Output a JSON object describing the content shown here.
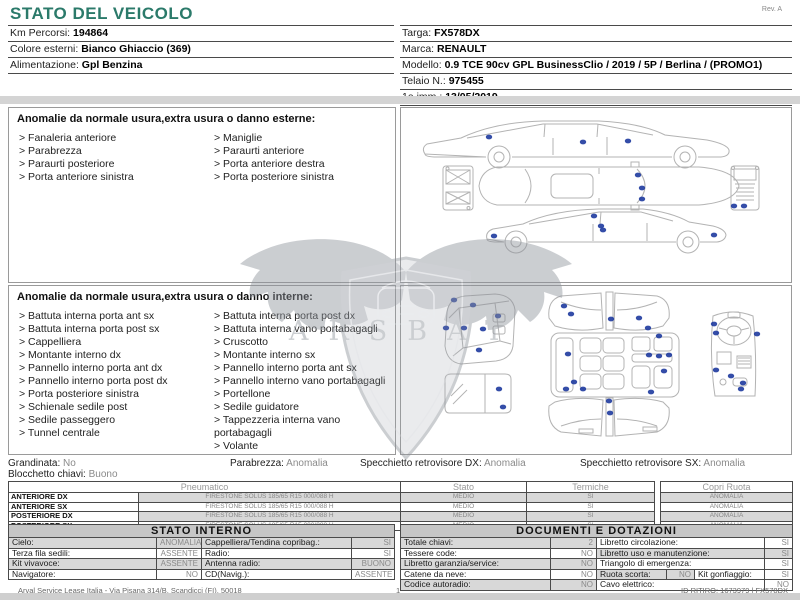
{
  "page": {
    "title": "STATO DEL VEICOLO",
    "revision": "Rev. A",
    "footer": {
      "company": "Arval Service Lease Italia - Via Pisana 314/B, Scandicci (FI), 50018",
      "page_number": "1",
      "ritiro_id": "ID RITIRO: 1673979 | FX578DX"
    }
  },
  "vehicle": {
    "left": [
      {
        "label": "Km Percorsi:",
        "value": "194864"
      },
      {
        "label": "Colore esterni:",
        "value": "Bianco Ghiaccio (369)"
      },
      {
        "label": "Alimentazione:",
        "value": "Gpl Benzina"
      }
    ],
    "right": [
      {
        "label": "Targa:",
        "value": "FX578DX"
      },
      {
        "label": "Marca:",
        "value": "RENAULT"
      },
      {
        "label": "Modello:",
        "value": "0.9 TCE 90cv GPL BusinessClio / 2019 / 5P / Berlina / (PROMO1)"
      },
      {
        "label": "Telaio N.:",
        "value": "975455"
      },
      {
        "label": "1a imm.:",
        "value": "13/05/2019"
      }
    ]
  },
  "external_anomalies": {
    "title": "Anomalie da normale usura,extra usura o danno esterne:",
    "col1": [
      "> Fanaleria anteriore",
      "> Parabrezza",
      "> Paraurti posteriore",
      "> Porta anteriore sinistra"
    ],
    "col2": [
      "> Maniglie",
      "> Paraurti anteriore",
      "> Porta anteriore destra",
      "> Porta posteriore sinistra"
    ]
  },
  "internal_anomalies": {
    "title": "Anomalie da normale usura,extra usura o danno interne:",
    "col1": [
      "> Battuta interna porta ant sx",
      "> Battuta interna porta post sx",
      "> Cappelliera",
      "> Montante interno dx",
      "> Pannello interno porta ant dx",
      "> Pannello interno porta post dx",
      "> Porta posteriore sinistra",
      "> Schienale sedile post",
      "> Sedile passeggero",
      "> Tunnel centrale"
    ],
    "col2": [
      "> Battuta interna porta post dx",
      "> Battuta interna vano portabagagli",
      "> Cruscotto",
      "> Montante interno sx",
      "> Pannello interno porta ant sx",
      "> Pannello interno vano portabagagli",
      "> Portellone",
      "> Sedile guidatore",
      "> Tappezzeria interna vano portabagagli",
      "> Volante"
    ]
  },
  "checks": [
    {
      "label": "Grandinata:",
      "value": "No"
    },
    {
      "label": "Parabrezza:",
      "value": "Anomalia"
    },
    {
      "label": "Specchietto retrovisore DX:",
      "value": "Anomalia"
    },
    {
      "label": "Specchietto retrovisore SX:",
      "value": "Anomalia"
    },
    {
      "label": "Blocchetto chiavi:",
      "value": "Buono"
    }
  ],
  "tyres": {
    "headers": [
      "Pneumatico",
      "Stato",
      "Termiche",
      "Copri Ruota"
    ],
    "rows": [
      {
        "position": "ANTERIORE DX",
        "tyre": "FIRESTONE SOLUS 185/65 R15 000/088 H",
        "stato": "MEDIO",
        "termiche": "SI",
        "copri_ruota": "ANOMALIA"
      },
      {
        "position": "ANTERIORE SX",
        "tyre": "FIRESTONE SOLUS 185/65 R15 000/088 H",
        "stato": "MEDIO",
        "termiche": "SI",
        "copri_ruota": "ANOMALIA"
      },
      {
        "position": "POSTERIORE DX",
        "tyre": "FIRESTONE SOLUS 185/65 R15 000/088 H",
        "stato": "MEDIO",
        "termiche": "SI",
        "copri_ruota": "ANOMALIA"
      },
      {
        "position": "POSTERIORE SX",
        "tyre": "FIRESTONE SOLUS 185/65 R15 000/088 H",
        "stato": "MEDIO",
        "termiche": "SI",
        "copri_ruota": "ANOMALIA"
      }
    ]
  },
  "stato_interno": {
    "title": "STATO INTERNO",
    "rows": [
      [
        {
          "label": "Cielo:",
          "value": "ANOMALIA"
        },
        {
          "label": "Cappelliera/Tendina copribag.:",
          "value": "SI"
        }
      ],
      [
        {
          "label": "Terza fila sedili:",
          "value": "ASSENTE"
        },
        {
          "label": "Radio:",
          "value": "SI"
        }
      ],
      [
        {
          "label": "Kit vivavoce:",
          "value": "ASSENTE"
        },
        {
          "label": "Antenna radio:",
          "value": "BUONO"
        }
      ],
      [
        {
          "label": "Navigatore:",
          "value": "NO"
        },
        {
          "label": "CD(Navig.):",
          "value": "ASSENTE"
        }
      ]
    ]
  },
  "documenti": {
    "title": "DOCUMENTI E DOTAZIONI",
    "rows": [
      [
        {
          "label": "Totale chiavi:",
          "value": "2"
        },
        {
          "label": "Libretto circolazione:",
          "value": "SI"
        }
      ],
      [
        {
          "label": "Tessere code:",
          "value": "NO"
        },
        {
          "label": "Libretto uso e manutenzione:",
          "value": "SI"
        }
      ],
      [
        {
          "label": "Libretto garanzia/service:",
          "value": "NO"
        },
        {
          "label": "Triangolo di emergenza:",
          "value": "SI"
        }
      ],
      [
        {
          "label": "Catene da neve:",
          "value": "NO"
        },
        {
          "label": "Ruota scorta:",
          "value": "NO"
        },
        {
          "label": "Kit gonfiaggio:",
          "value": "SI"
        }
      ],
      [
        {
          "label": "Codice autoradio:",
          "value": "NO"
        },
        {
          "label": "Cavo elettrico:",
          "value": "NO"
        }
      ]
    ]
  },
  "watermark": {
    "letters": "ARSBAT"
  }
}
